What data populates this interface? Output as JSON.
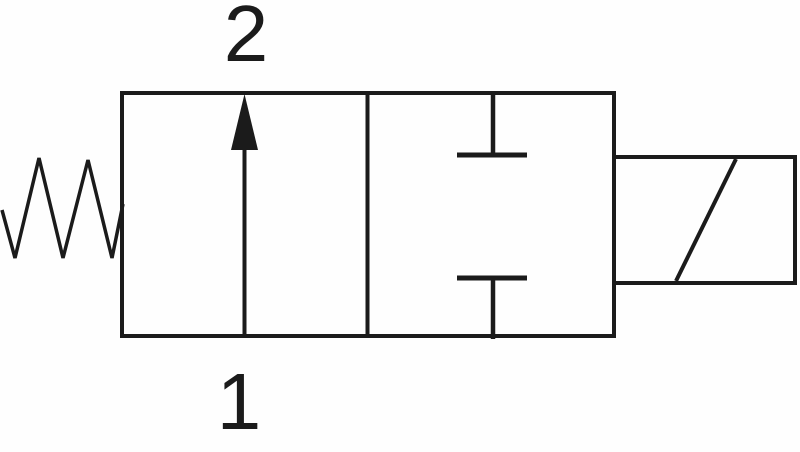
{
  "diagram": {
    "type": "valve-schematic-symbol",
    "ports": {
      "top": {
        "label": "2"
      },
      "bottom": {
        "label": "1"
      }
    },
    "components": {
      "left": "spring-return-icon",
      "position1": "flow-arrow-up-icon",
      "position2": "blocked-ports-icon",
      "actuator": "solenoid-coil-icon"
    },
    "colors": {
      "line": "#1b1b1b",
      "background": "#fefefe",
      "text": "#1b1b1b"
    }
  }
}
